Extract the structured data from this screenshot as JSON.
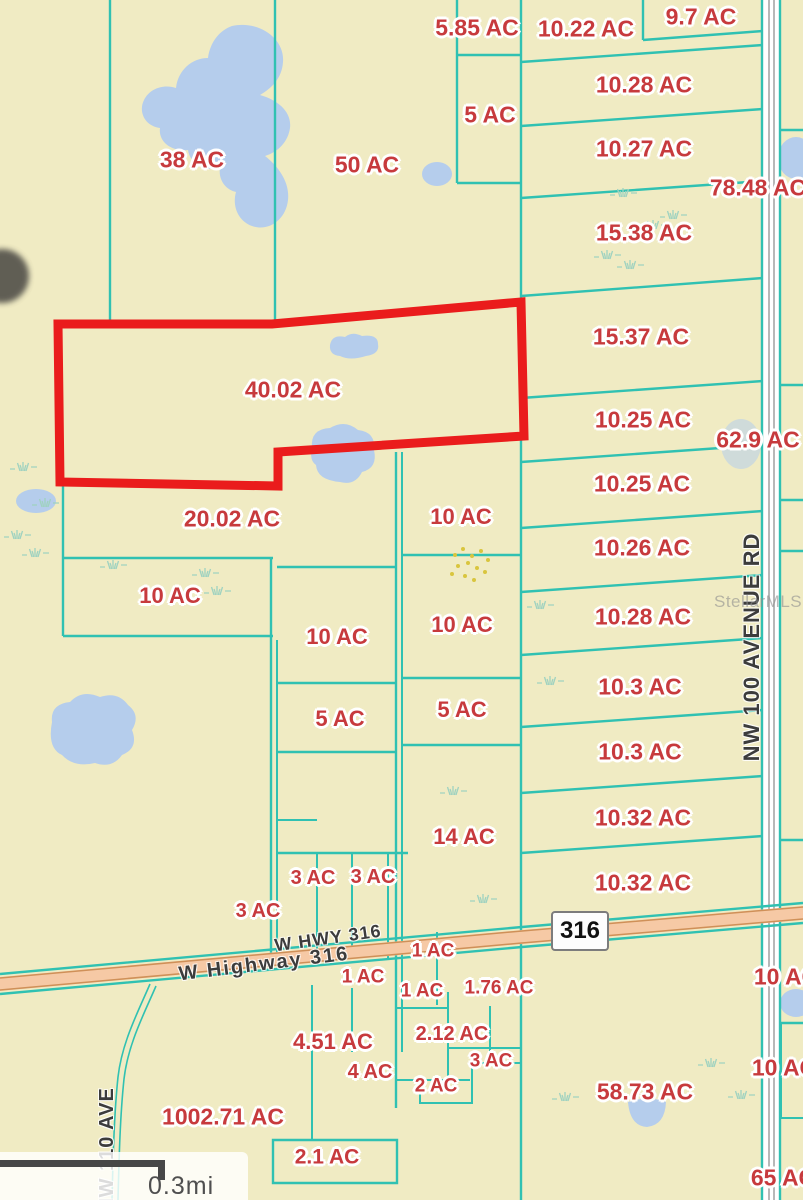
{
  "map": {
    "type": "real-estate-parcel-map",
    "watermark": "StellarMLS",
    "scale_label": "0.3mi",
    "highway_shield": "316",
    "colors": {
      "bg": "#f0ebc3",
      "teal": "#30c1b2",
      "lake": "#b5cdec",
      "sel-red": "#ea1c1c",
      "label-red": "#c73a3d",
      "road-fill": "#f6c9a5",
      "road-edge": "#cf9058",
      "road-gray": "#9a9a9a",
      "dark-text": "#3c3c3c",
      "watermark": "#8f8f8f",
      "scale": "#474747",
      "grass": "#9fd2c0",
      "speckle": "#d9c53e"
    },
    "selected_parcel": {
      "label": "40.02 AC",
      "outline_color": "#ea1c1c"
    },
    "parcel_labels": [
      {
        "text": "38 AC",
        "x": 192,
        "y": 160,
        "fs": 23
      },
      {
        "text": "50 AC",
        "x": 367,
        "y": 165,
        "fs": 23
      },
      {
        "text": "5.85 AC",
        "x": 477,
        "y": 28,
        "fs": 23
      },
      {
        "text": "10.22 AC",
        "x": 586,
        "y": 29,
        "fs": 23
      },
      {
        "text": "9.7 AC",
        "x": 701,
        "y": 17,
        "fs": 23
      },
      {
        "text": "10.28 AC",
        "x": 644,
        "y": 85,
        "fs": 23
      },
      {
        "text": "5 AC",
        "x": 490,
        "y": 115,
        "fs": 23
      },
      {
        "text": "10.27 AC",
        "x": 644,
        "y": 149,
        "fs": 23
      },
      {
        "text": "78.48 AC",
        "x": 758,
        "y": 188,
        "fs": 23
      },
      {
        "text": "15.38 AC",
        "x": 644,
        "y": 233,
        "fs": 23
      },
      {
        "text": "15.37 AC",
        "x": 641,
        "y": 337,
        "fs": 23
      },
      {
        "text": "40.02 AC",
        "x": 293,
        "y": 390,
        "fs": 23
      },
      {
        "text": "10.25 AC",
        "x": 643,
        "y": 420,
        "fs": 23
      },
      {
        "text": "62.9 AC",
        "x": 758,
        "y": 440,
        "fs": 23
      },
      {
        "text": "10.25 AC",
        "x": 642,
        "y": 484,
        "fs": 23
      },
      {
        "text": "20.02 AC",
        "x": 232,
        "y": 519,
        "fs": 23
      },
      {
        "text": "10 AC",
        "x": 461,
        "y": 517,
        "fs": 22
      },
      {
        "text": "10.26 AC",
        "x": 642,
        "y": 548,
        "fs": 23
      },
      {
        "text": "10 AC",
        "x": 170,
        "y": 596,
        "fs": 22
      },
      {
        "text": "10.28 AC",
        "x": 643,
        "y": 617,
        "fs": 23
      },
      {
        "text": "10 AC",
        "x": 337,
        "y": 637,
        "fs": 22
      },
      {
        "text": "10 AC",
        "x": 462,
        "y": 625,
        "fs": 22
      },
      {
        "text": "10.3 AC",
        "x": 640,
        "y": 687,
        "fs": 23
      },
      {
        "text": "5 AC",
        "x": 340,
        "y": 719,
        "fs": 22
      },
      {
        "text": "5 AC",
        "x": 462,
        "y": 710,
        "fs": 22
      },
      {
        "text": "10.3 AC",
        "x": 640,
        "y": 752,
        "fs": 23
      },
      {
        "text": "10.32 AC",
        "x": 643,
        "y": 818,
        "fs": 23
      },
      {
        "text": "14 AC",
        "x": 464,
        "y": 837,
        "fs": 22
      },
      {
        "text": "3 AC",
        "x": 313,
        "y": 878,
        "fs": 20
      },
      {
        "text": "3 AC",
        "x": 373,
        "y": 877,
        "fs": 20
      },
      {
        "text": "10.32 AC",
        "x": 643,
        "y": 883,
        "fs": 23
      },
      {
        "text": "3 AC",
        "x": 258,
        "y": 911,
        "fs": 20
      },
      {
        "text": "1 AC",
        "x": 433,
        "y": 951,
        "fs": 19
      },
      {
        "text": "1 AC",
        "x": 363,
        "y": 977,
        "fs": 19
      },
      {
        "text": "1 AC",
        "x": 422,
        "y": 991,
        "fs": 19
      },
      {
        "text": "1.76 AC",
        "x": 499,
        "y": 988,
        "fs": 19
      },
      {
        "text": "2.12 AC",
        "x": 452,
        "y": 1034,
        "fs": 20
      },
      {
        "text": "4.51 AC",
        "x": 333,
        "y": 1042,
        "fs": 22
      },
      {
        "text": "3 AC",
        "x": 491,
        "y": 1061,
        "fs": 19
      },
      {
        "text": "4 AC",
        "x": 370,
        "y": 1072,
        "fs": 20
      },
      {
        "text": "2 AC",
        "x": 436,
        "y": 1086,
        "fs": 19
      },
      {
        "text": "58.73 AC",
        "x": 645,
        "y": 1092,
        "fs": 23
      },
      {
        "text": "10 AC",
        "x": 786,
        "y": 977,
        "fs": 23
      },
      {
        "text": "1002.71 AC",
        "x": 223,
        "y": 1117,
        "fs": 23
      },
      {
        "text": "10 AC",
        "x": 784,
        "y": 1068,
        "fs": 23
      },
      {
        "text": "2.1 AC",
        "x": 327,
        "y": 1157,
        "fs": 21
      },
      {
        "text": "65 AC",
        "x": 783,
        "y": 1178,
        "fs": 23
      }
    ],
    "road_labels": [
      {
        "text": "W HWY 316",
        "x": 328,
        "y": 938,
        "fs": 18,
        "rotate": -8,
        "spacing": 1
      },
      {
        "text": "W Highway 316",
        "x": 264,
        "y": 964,
        "fs": 20,
        "rotate": -7,
        "spacing": 2
      },
      {
        "text": "NW 100 AVENUE RD",
        "x": 752,
        "y": 647,
        "fs": 22,
        "rotate": -90,
        "spacing": 1
      },
      {
        "text": "NW 110 AVE",
        "x": 107,
        "y": 1150,
        "fs": 20,
        "rotate": -90,
        "spacing": 1
      }
    ]
  }
}
